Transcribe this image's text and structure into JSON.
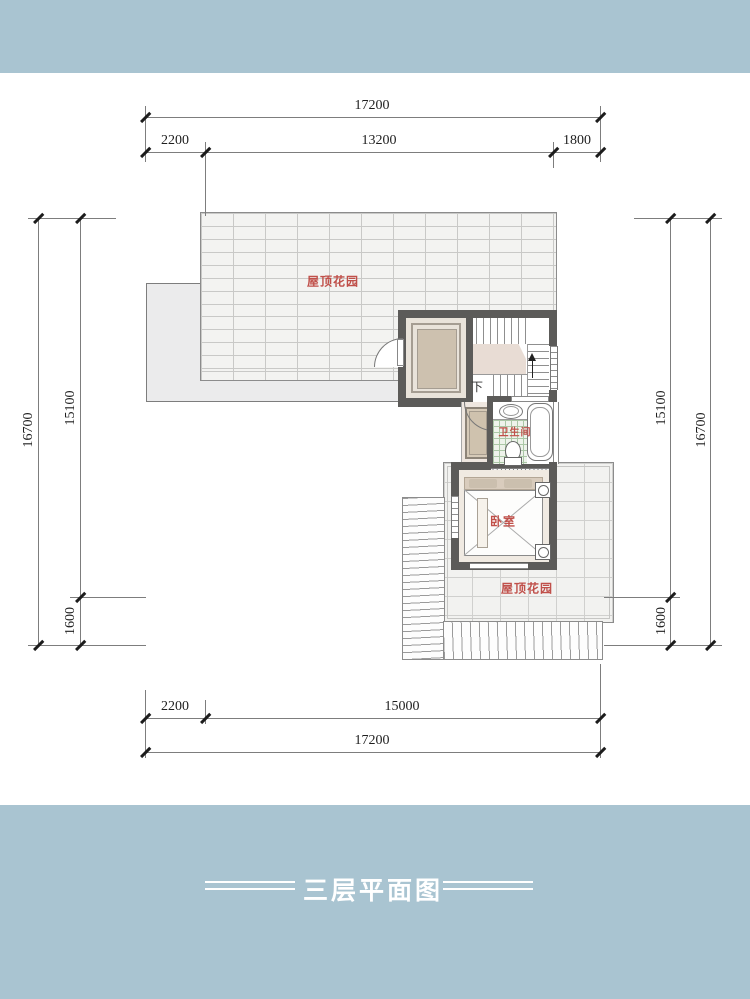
{
  "footer": {
    "title": "三层平面图"
  },
  "plan": {
    "labels": {
      "roof_garden_top": "屋顶花园",
      "roof_garden_bottom": "屋顶花园",
      "bedroom": "卧室",
      "bathroom": "卫生间",
      "stair_down": "下"
    }
  },
  "dimensions": {
    "top": {
      "overall": "17200",
      "seg1": "2200",
      "seg2": "13200",
      "seg3": "1800"
    },
    "bottom": {
      "overall": "17200",
      "seg1": "2200",
      "seg2": "15000"
    },
    "left": {
      "overall": "16700",
      "seg1": "15100",
      "seg2": "1600"
    },
    "right": {
      "overall": "16700",
      "seg1": "15100",
      "seg2": "1600"
    }
  },
  "colors": {
    "band": "#a9c4d1",
    "wall": "#5c5b59",
    "label_red": "#c0504a",
    "elevator_tan": "#cdc1af",
    "landing_pink": "#e8dcd4"
  }
}
